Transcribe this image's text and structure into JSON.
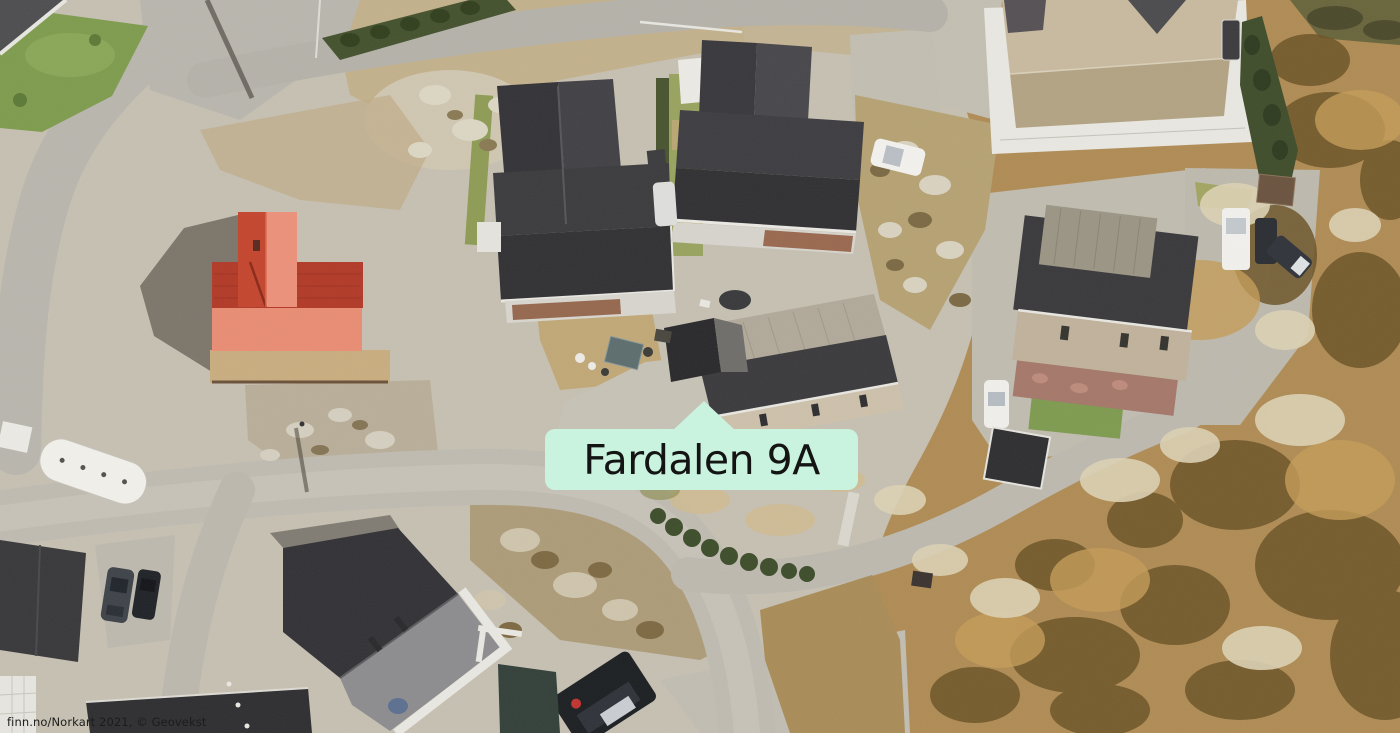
{
  "map": {
    "marker": {
      "label": "Fardalen 9A",
      "background_color": "#c9f3de",
      "text_color": "#141414"
    },
    "attribution": {
      "text": "finn.no/Norkart 2021, © Geovekst"
    }
  }
}
